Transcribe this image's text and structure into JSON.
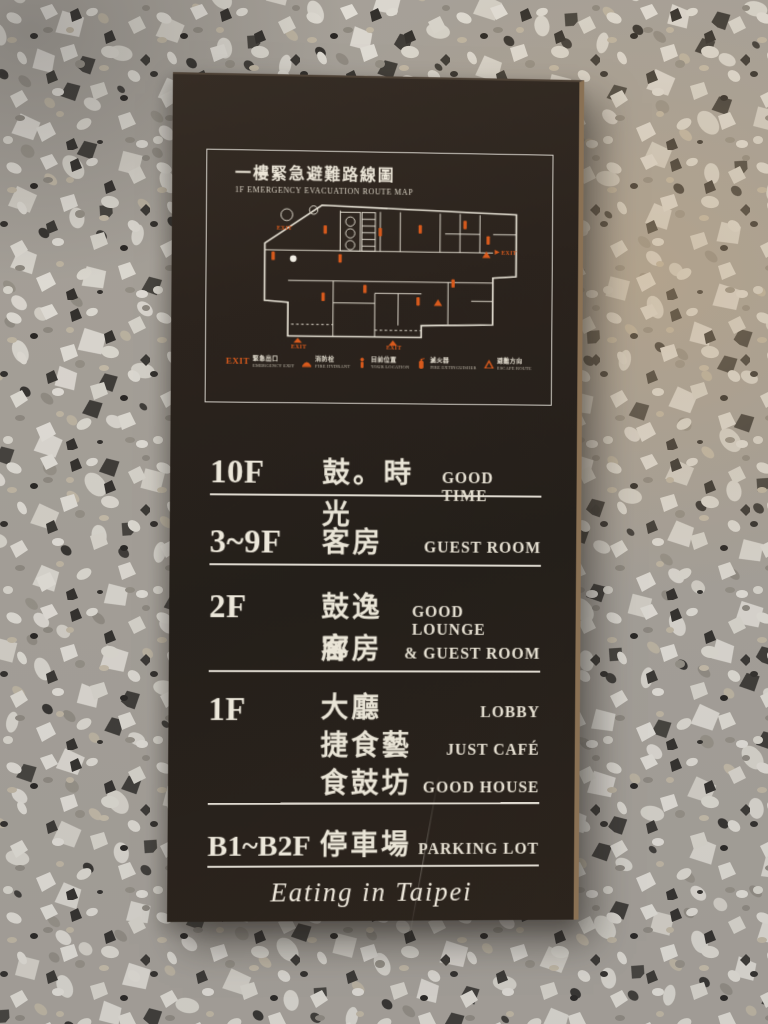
{
  "sign": {
    "map_panel": {
      "title_zh": "一樓緊急避難路線圖",
      "title_en": "1F EMERGENCY EVACUATION ROUTE MAP",
      "exit_label": "EXIT",
      "legend": [
        {
          "icon": "exit-badge",
          "zh": "緊急出口",
          "en": "EMERGENCY EXIT"
        },
        {
          "icon": "fire-hydrant",
          "zh": "消防栓",
          "en": "FIRE HYDRANT"
        },
        {
          "icon": "your-location",
          "zh": "目前位置",
          "en": "YOUR LOCATION"
        },
        {
          "icon": "fire-extinguisher",
          "zh": "滅火器",
          "en": "FIRE EXTINGUISHER"
        },
        {
          "icon": "escape-direction",
          "zh": "避難方向",
          "en": "ESCAPE ROUTE"
        }
      ]
    },
    "directory": {
      "rows": [
        {
          "floor": "10F",
          "lines": [
            {
              "zh": "鼓。時光",
              "en": "GOOD TIME"
            }
          ]
        },
        {
          "floor": "3~9F",
          "lines": [
            {
              "zh": "客房",
              "en": "GUEST ROOM"
            }
          ]
        },
        {
          "floor": "2F",
          "lines": [
            {
              "zh": "鼓逸廊",
              "en": "GOOD LOUNGE"
            },
            {
              "zh": "客房",
              "en": "& GUEST ROOM"
            }
          ]
        },
        {
          "floor": "1F",
          "lines": [
            {
              "zh": "大廳",
              "en": "LOBBY"
            },
            {
              "zh": "捷食藝",
              "en": "JUST CAFÉ"
            },
            {
              "zh": "食鼓坊",
              "en": "GOOD HOUSE"
            }
          ]
        },
        {
          "floor": "B1~B2F",
          "lines": [
            {
              "zh": "停車場",
              "en": "PARKING LOT"
            }
          ]
        }
      ]
    },
    "footer_script": "Eating in Taipei"
  },
  "colors": {
    "accent_orange": "#d85a1d",
    "sign_background": "#282019",
    "line_white": "#e8e3d6",
    "wall_gray": "#aba59c"
  }
}
